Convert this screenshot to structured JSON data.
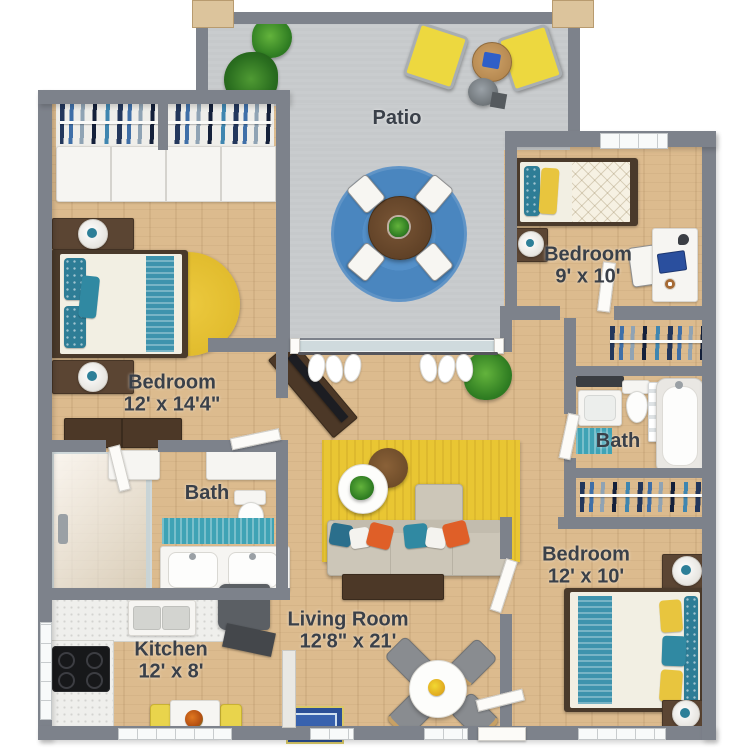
{
  "plan_title": "Apartment 3D floor plan",
  "rooms": [
    {
      "name": "Patio",
      "dims": ""
    },
    {
      "name": "Bedroom",
      "dims": "12' x 14'4\""
    },
    {
      "name": "Bedroom",
      "dims": "9' x 10'"
    },
    {
      "name": "Bath",
      "dims": ""
    },
    {
      "name": "Bedroom",
      "dims": "12' x 10'"
    },
    {
      "name": "Bath",
      "dims": ""
    },
    {
      "name": "Kitchen",
      "dims": "12' x 8'"
    },
    {
      "name": "Living Room",
      "dims": "12'8\" x 21'"
    }
  ],
  "palette": {
    "wall_gray": "#7d828b",
    "wood_floor": "#dcbb8e",
    "patio_floor": "#c6c9cb",
    "accent_teal": "#2e7d96",
    "accent_yellow": "#e8c53e",
    "patio_rug_blue": "#4f8cc5",
    "living_rug_yellow": "#e9c633",
    "sofa_beige": "#ccc6b8",
    "pillow_orange": "#df5f28",
    "label_text": "#3a4049"
  }
}
